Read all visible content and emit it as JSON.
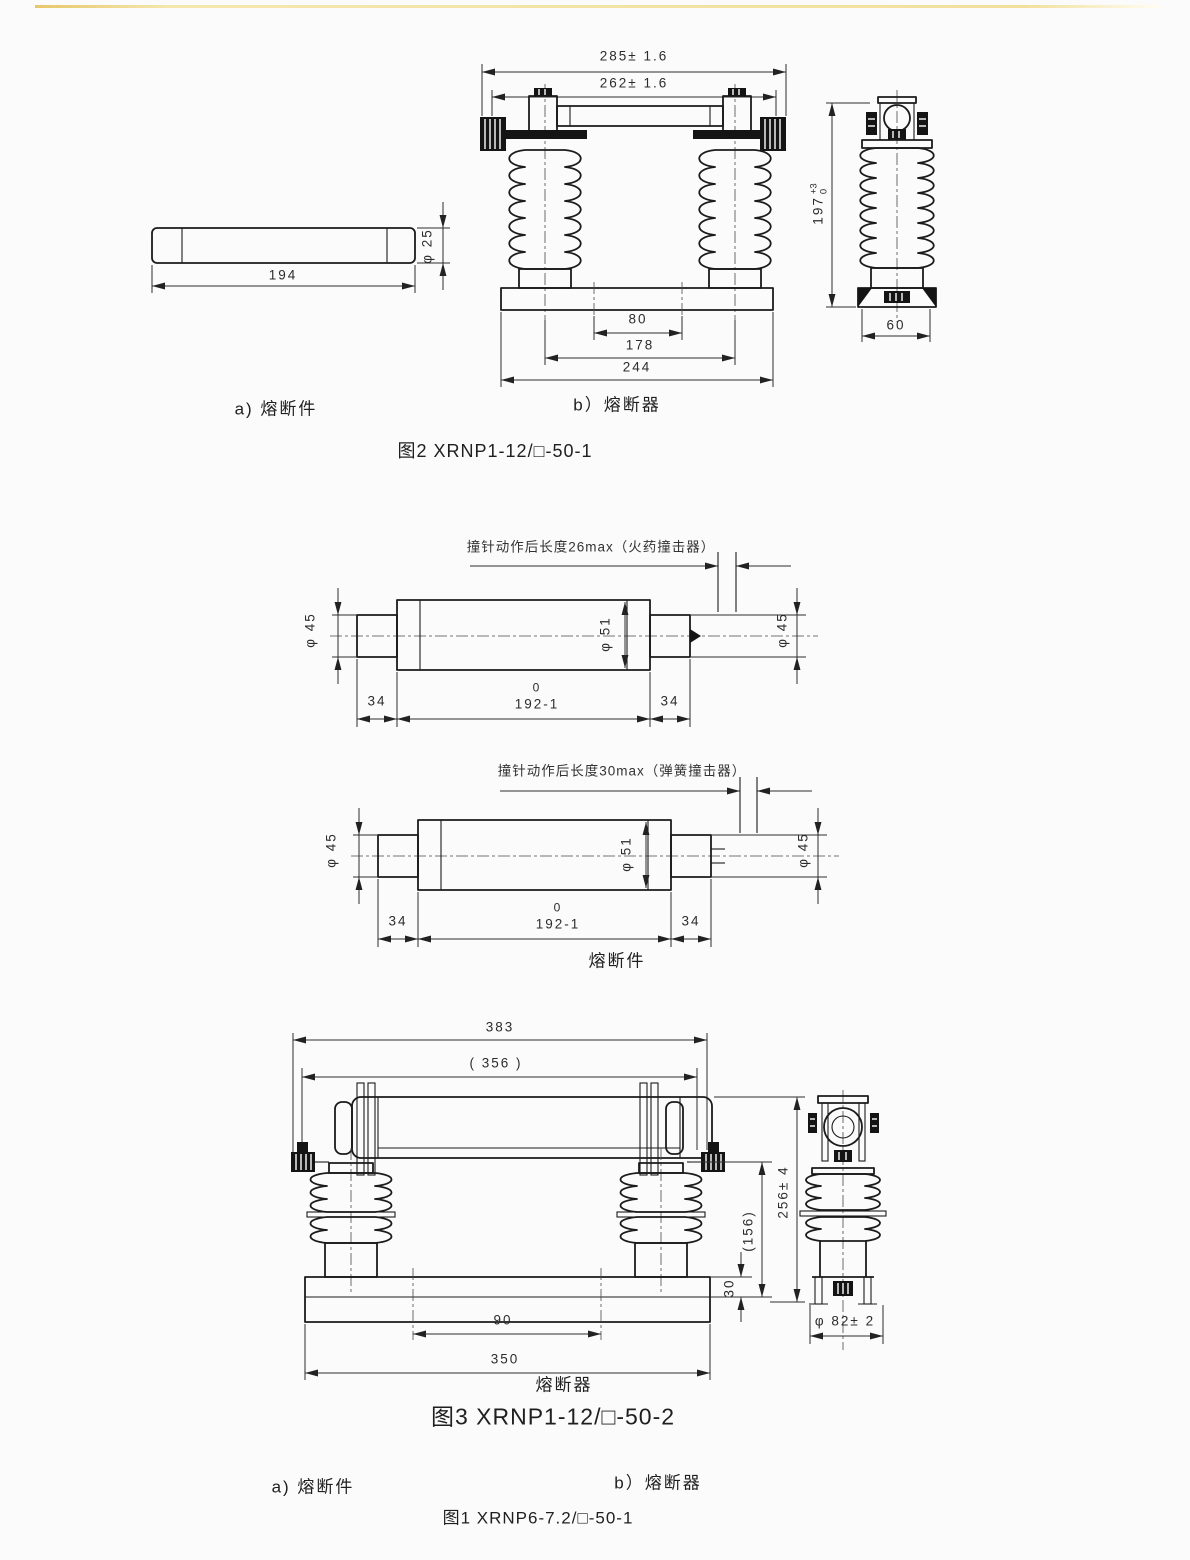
{
  "page": {
    "background": "#fbfbfc",
    "top_rule_color": "#eed98e",
    "line_color": "#1b1b1b"
  },
  "fig2": {
    "caption": "图2  XRNP1-12/□-50-1",
    "label_a": "a) 熔断件",
    "label_b": "b）熔断器",
    "element": {
      "length": "194",
      "diameter": "φ 25"
    },
    "front": {
      "dim_overall": "285± 1.6",
      "dim_inner": "262± 1.6",
      "dim_hole_span": "80",
      "dim_center_span": "178",
      "dim_base": "244"
    },
    "side": {
      "height": "197",
      "height_tol_upper": "+3",
      "height_tol_lower": "0",
      "width": "60"
    }
  },
  "links": {
    "section_label": "熔断件",
    "link1": {
      "annotation": "撞针动作后长度26max（火药撞击器）",
      "dia_left": "φ 45",
      "dia_right": "φ 45",
      "dia_body": "φ 51",
      "cap_left": "34",
      "body_tol_upper": "0",
      "body_length": "192-1",
      "cap_right": "34"
    },
    "link2": {
      "annotation": "撞针动作后长度30max（弹簧撞击器）",
      "dia_left": "φ 45",
      "dia_right": "φ 45",
      "dia_body": "φ 51",
      "cap_left": "34",
      "body_tol_upper": "0",
      "body_length": "192-1",
      "cap_right": "34"
    }
  },
  "fig3": {
    "caption": "图3 XRNP1-12/□-50-2",
    "label": "熔断器",
    "front": {
      "dim_overall": "383",
      "dim_inner": "( 356 )",
      "dim_holes": "90",
      "dim_base": "350"
    },
    "side": {
      "dim_height": "256± 4",
      "dim_insulator": "(156)",
      "dim_plate": "30",
      "dim_dia": "φ 82± 2"
    }
  },
  "fig1_footer": {
    "label_a": "a) 熔断件",
    "label_b": "b）熔断器",
    "caption": "图1 XRNP6-7.2/□-50-1"
  }
}
